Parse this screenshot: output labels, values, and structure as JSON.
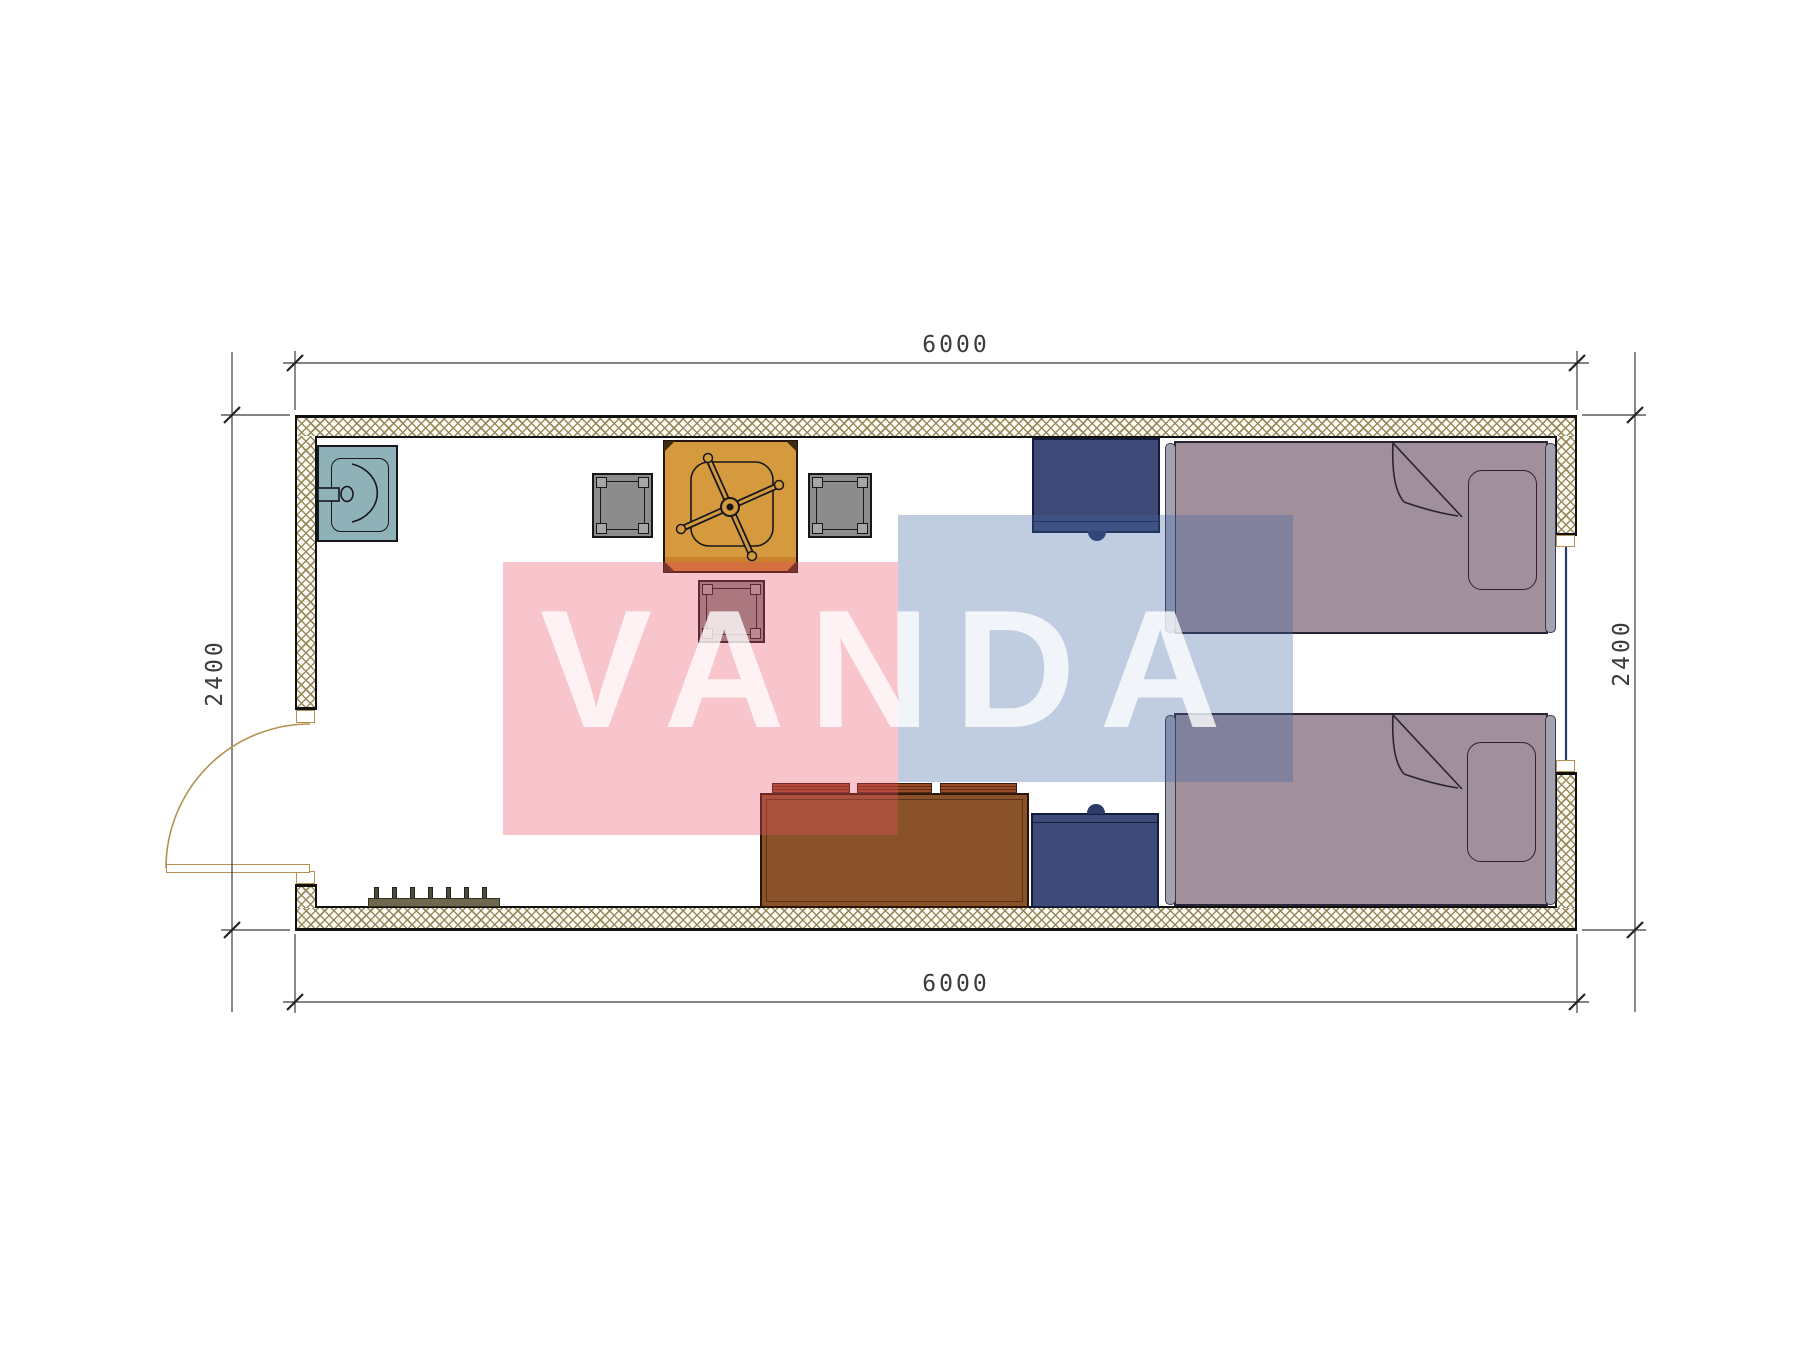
{
  "title": "container-room-floor-plan",
  "dimensions": {
    "top": "6000",
    "bottom": "6000",
    "left": "2400",
    "right": "2400"
  },
  "watermark": {
    "text": "VANDA",
    "pink_hex": "#f5bfc9",
    "blue_hex": "#bccbdd",
    "text_color": "rgba(255,255,255,0.78)"
  },
  "palette": {
    "wall_hatch": "#968657",
    "wall_outline": "#111111",
    "sink": "#8fb2b9",
    "table": "#d59a3d",
    "table_shade": "#c9812e",
    "stool": "#8c8c8c",
    "nightstand": "#3e4a77",
    "bed": "#a18f9c",
    "bed_rail": "#a3a3b0",
    "sofa": "#8a5229",
    "sofa_cushion": "#9a4a26",
    "door": "#b5914f",
    "window_glass": "#2a3a6e",
    "coat_hooks": "#6e6850",
    "dimension_lines": "#3b3b3b"
  },
  "icons": [
    "sink-icon",
    "dining-table-icon",
    "office-chair-icon",
    "stool-icon",
    "nightstand-icon",
    "single-bed-icon",
    "pillow-icon",
    "sofa-icon",
    "coat-hooks-icon",
    "door-swing-icon",
    "window-icon",
    "dimension-tick-icon"
  ]
}
